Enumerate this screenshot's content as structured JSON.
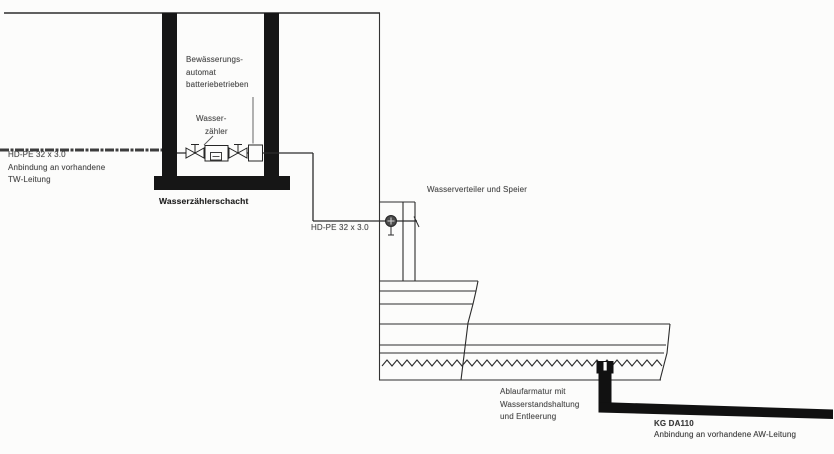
{
  "meta": {
    "drawing_type": "fountain water-supply and drain schematic",
    "language": "de"
  },
  "colors": {
    "paper": "#fcfcfb",
    "ink": "#262626",
    "shaft_wall_fill": "#161616",
    "label_gray": "#4a4a4a",
    "drain_black": "#111111"
  },
  "icons": {
    "valve": "shutoff-valve-icon (bowtie with T-handle)",
    "meter": "water-meter-box-icon",
    "automat": "irrigation-automat-box-icon",
    "tap": "spout-fitting-icon (hatched circle with stem)"
  },
  "labels": {
    "tw": {
      "l1": "HD-PE 32 x 3.0",
      "l2": "Anbindung an vorhandene",
      "l3": "TW-Leitung"
    },
    "automat": {
      "l1": "Bewässerungs-",
      "l2": "automat",
      "l3": "batteriebetrieben"
    },
    "meter": {
      "l1": "Wasser-",
      "l2": "zähler"
    },
    "shaft_title": "Wasserzählerschacht",
    "supply_pipe": "HD-PE 32 x 3.0",
    "distributor": "Wasserverteiler und Speier",
    "drain": {
      "l1": "Ablaufarmatur mit",
      "l2": "Wasserstandshaltung",
      "l3": "und Entleerung"
    },
    "aw": {
      "l1": "KG DA110",
      "l2": "Anbindung an vorhandene AW-Leitung"
    }
  }
}
